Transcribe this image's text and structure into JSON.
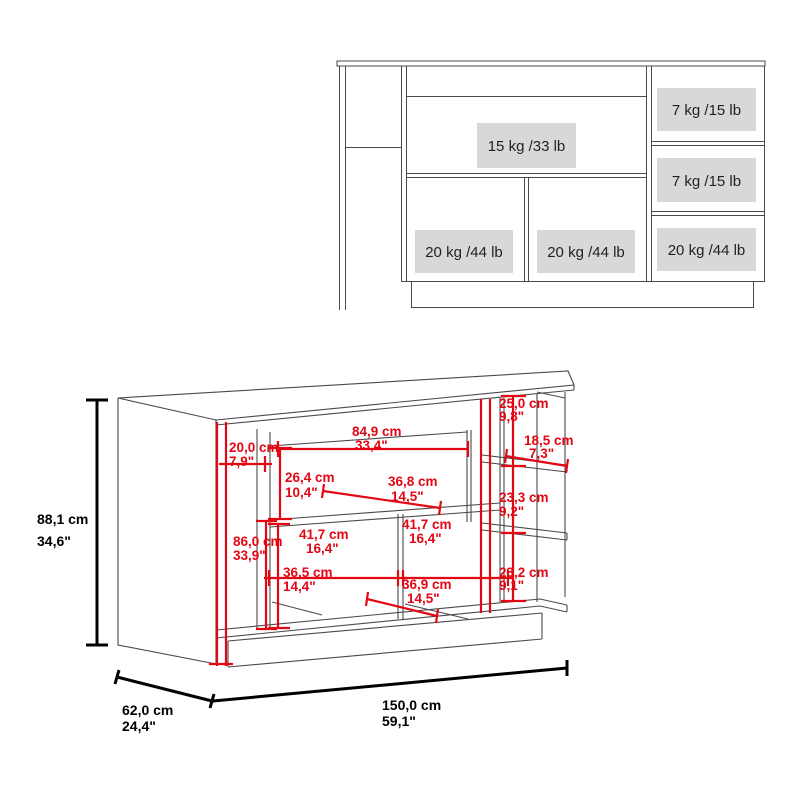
{
  "top_view": {
    "label_bg": "#d8d8d8",
    "capacity_labels": {
      "shelf_mid": "15 kg /33 lb",
      "drawer_top": "7 kg /15 lb",
      "drawer_middle": "7 kg /15 lb",
      "cabinet_left": "20 kg /44 lb",
      "cabinet_middle": "20 kg /44 lb",
      "cabinet_right": "20 kg /44 lb"
    }
  },
  "iso_view": {
    "dim_color": "#e30613",
    "line_color": "#4a4a4a",
    "dimensions": {
      "width_849": {
        "cm": "84,9 cm",
        "inch": "33,4\""
      },
      "depth_200": {
        "cm": "20,0 cm",
        "inch": "7,9\""
      },
      "height_264": {
        "cm": "26,4 cm",
        "inch": "10,4\""
      },
      "depth_368": {
        "cm": "36,8 cm",
        "inch": "14,5\""
      },
      "height_860": {
        "cm": "86,0 cm",
        "inch": "33,9\""
      },
      "width_417_left": {
        "cm": "41,7 cm",
        "inch": "16,4\""
      },
      "width_417_right": {
        "cm": "41,7 cm",
        "inch": "16,4\""
      },
      "height_365": {
        "cm": "36,5 cm",
        "inch": "14,4\""
      },
      "depth_369": {
        "cm": "36,9 cm",
        "inch": "14,5\""
      },
      "height_250": {
        "cm": "25,0 cm",
        "inch": "9,8\""
      },
      "depth_185": {
        "cm": "18,5 cm",
        "inch": "7,3\""
      },
      "height_233": {
        "cm": "23,3 cm",
        "inch": "9,2\""
      },
      "height_232": {
        "cm": "23,2 cm",
        "inch": "9,1\""
      },
      "total_height": {
        "cm": "88,1 cm",
        "inch": "34,6\""
      },
      "total_depth": {
        "cm": "62,0 cm",
        "inch": "24,4\""
      },
      "total_width": {
        "cm": "150,0 cm",
        "inch": "59,1\""
      }
    }
  }
}
